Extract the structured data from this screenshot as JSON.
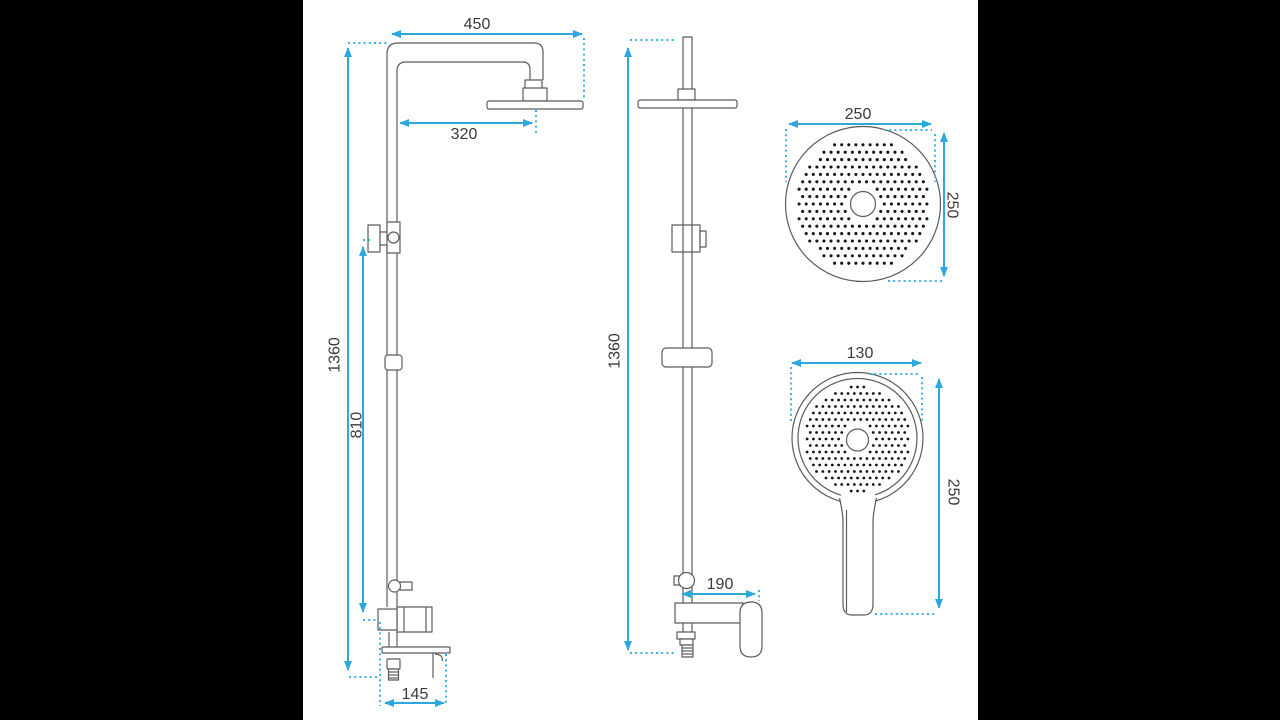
{
  "drawing_title": "shower-set-dimension-drawing",
  "colors": {
    "dimension_line": "#2ea7dc",
    "dotted_line": "#3fb2e2",
    "line_art": "#5b5c5e",
    "nozzle_dot": "#151515",
    "panel_bg": "#ffffff",
    "letterbox": "#000000"
  },
  "views": {
    "side": {
      "width_top": "450",
      "head_offset": "320",
      "height_total": "1360",
      "mixer_height": "810",
      "base_depth": "145"
    },
    "front": {
      "height_total": "1360",
      "spout_reach": "190"
    },
    "head": {
      "width": "250",
      "height": "250"
    },
    "hand": {
      "width": "130",
      "length": "250"
    }
  },
  "shower_faces": {
    "head": {
      "cx": 560,
      "cy": 204,
      "dots_r": 66,
      "hub_excl": 18.5,
      "col": 7.1,
      "row": 7.4,
      "dot_r": 1.55
    },
    "hand": {
      "cx": 554.5,
      "cy": 439,
      "dots_r": 52.5,
      "hub_excl": 16.5,
      "col": 6.3,
      "row": 6.5,
      "dot_r": 1.4
    }
  }
}
